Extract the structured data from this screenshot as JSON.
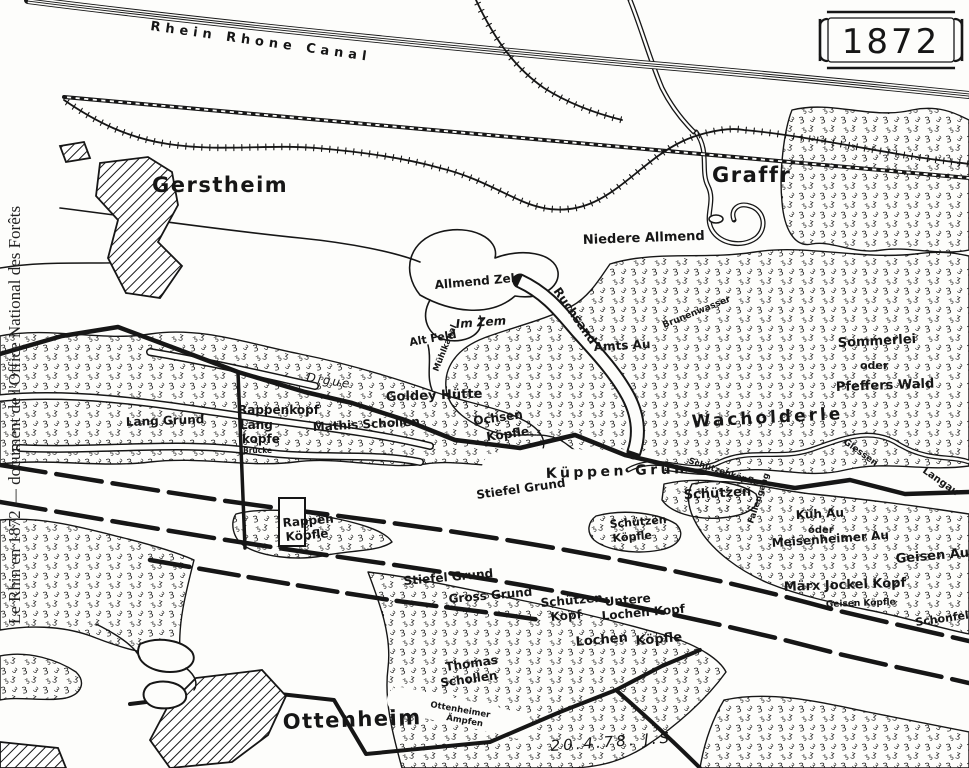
{
  "colors": {
    "ink": "#161616",
    "paper": "#fdfdfb"
  },
  "margin_caption": "Le Rhin en 1872 — document de l'Office National des Forêts",
  "cartouche": {
    "year": "1872"
  },
  "signature": "20.4.78. J.S.",
  "map": {
    "towns": [
      "Gerstheim",
      "Graffr",
      "Ottenheim"
    ],
    "waterways": [
      "Rhein Rhone Canal",
      "Ruchsand",
      "Brunenwasser",
      "Mühlkanal",
      "Giessen"
    ],
    "labels": [
      {
        "id": "canal-label",
        "text": "Rhein Rhone Canal",
        "x": 150,
        "y": 30,
        "r": 8,
        "c": "canal"
      },
      {
        "id": "gerstheim",
        "text": "Gerstheim",
        "x": 152,
        "y": 192,
        "r": 0,
        "c": "town"
      },
      {
        "id": "graffr",
        "text": "Graffr",
        "x": 712,
        "y": 182,
        "r": 0,
        "c": "town"
      },
      {
        "id": "niedere-allmend",
        "text": "Niedere Allmend",
        "x": 583,
        "y": 244,
        "r": -2,
        "c": "h13"
      },
      {
        "id": "allmend-zeh",
        "text": "Allmend Zeh",
        "x": 435,
        "y": 289,
        "r": -5,
        "c": "h12"
      },
      {
        "id": "im-zem",
        "text": "Im Zem",
        "x": 456,
        "y": 328,
        "r": -4,
        "c": "h12i"
      },
      {
        "id": "alt-feld",
        "text": "Alt Feld",
        "x": 410,
        "y": 346,
        "r": -10,
        "c": "h11"
      },
      {
        "id": "muhlkanal",
        "text": "Mühlkanal",
        "x": 438,
        "y": 372,
        "r": -68,
        "c": "h8"
      },
      {
        "id": "ruchsand",
        "text": "Ruchsand",
        "x": 553,
        "y": 291,
        "r": 55,
        "c": "h12"
      },
      {
        "id": "brunenwasser",
        "text": "Brunenwasser",
        "x": 664,
        "y": 328,
        "r": -22,
        "c": "h9"
      },
      {
        "id": "amts-au",
        "text": "Amts Au",
        "x": 594,
        "y": 351,
        "r": -3,
        "c": "h12"
      },
      {
        "id": "sommerlei",
        "text": "Sommerlei",
        "x": 838,
        "y": 347,
        "r": -3,
        "c": "h13"
      },
      {
        "id": "oder-1",
        "text": "oder",
        "x": 860,
        "y": 369,
        "r": 0,
        "c": "h11"
      },
      {
        "id": "pfeffers-wald",
        "text": "Pfeffers Wald",
        "x": 836,
        "y": 391,
        "r": -2,
        "c": "h13"
      },
      {
        "id": "wacholderle",
        "text": "Wacholderle",
        "x": 692,
        "y": 427,
        "r": -3,
        "c": "h16"
      },
      {
        "id": "digue",
        "text": "Digue",
        "x": 306,
        "y": 381,
        "r": 9,
        "c": "script"
      },
      {
        "id": "lang-grund",
        "text": "Lang Grund",
        "x": 126,
        "y": 426,
        "r": -2,
        "c": "h12"
      },
      {
        "id": "rappenkopf-1",
        "text": "Rappenkopf",
        "x": 238,
        "y": 414,
        "r": 0,
        "c": "h12"
      },
      {
        "id": "rappenkopf-2",
        "text": "Lang",
        "x": 240,
        "y": 429,
        "r": 0,
        "c": "h12"
      },
      {
        "id": "rappenkopf-3",
        "text": "kopfe",
        "x": 242,
        "y": 443,
        "r": 0,
        "c": "h12"
      },
      {
        "id": "brucke",
        "text": "Brücke",
        "x": 243,
        "y": 453,
        "r": 0,
        "c": "h7"
      },
      {
        "id": "mathis-schollen",
        "text": "Mathis Schollen",
        "x": 313,
        "y": 431,
        "r": -3,
        "c": "h12"
      },
      {
        "id": "goldey-hutte",
        "text": "Goldey Hütte",
        "x": 386,
        "y": 401,
        "r": -2,
        "c": "h13"
      },
      {
        "id": "ochsen",
        "text": "Ochsen",
        "x": 474,
        "y": 425,
        "r": -8,
        "c": "h12"
      },
      {
        "id": "ochsen-kopfle",
        "text": "Köpfle",
        "x": 487,
        "y": 441,
        "r": -8,
        "c": "h12"
      },
      {
        "id": "kuppen-grun",
        "text": "Küppen Grün",
        "x": 546,
        "y": 478,
        "r": -2,
        "c": "h14"
      },
      {
        "id": "stiefel-grund-1",
        "text": "Stiefel Grund",
        "x": 477,
        "y": 499,
        "r": -8,
        "c": "h12"
      },
      {
        "id": "schutzen",
        "text": "Schützen",
        "x": 684,
        "y": 499,
        "r": -3,
        "c": "h13"
      },
      {
        "id": "schutzenkopfle-giessen",
        "text": "Schützenköpfle",
        "x": 688,
        "y": 463,
        "r": 18,
        "c": "h8"
      },
      {
        "id": "giessen",
        "text": "Giessen",
        "x": 843,
        "y": 443,
        "r": 36,
        "c": "h9"
      },
      {
        "id": "schutzen-kopfle-1",
        "text": "Schützen",
        "x": 610,
        "y": 528,
        "r": -5,
        "c": "h11"
      },
      {
        "id": "schutzen-kopfle-2",
        "text": "Köpfle",
        "x": 613,
        "y": 542,
        "r": -5,
        "c": "h11"
      },
      {
        "id": "kuh-au",
        "text": "Küh Au",
        "x": 796,
        "y": 519,
        "r": -3,
        "c": "h12"
      },
      {
        "id": "oder-2",
        "text": "oder",
        "x": 808,
        "y": 533,
        "r": 0,
        "c": "h10"
      },
      {
        "id": "meisenheimer-au",
        "text": "Meisenheimer Au",
        "x": 772,
        "y": 547,
        "r": -4,
        "c": "h12"
      },
      {
        "id": "geisen-au",
        "text": "Geisen Au",
        "x": 896,
        "y": 563,
        "r": -5,
        "c": "h13"
      },
      {
        "id": "marx-jockel-kopf",
        "text": "Märx Jockel Kopf",
        "x": 784,
        "y": 591,
        "r": -2,
        "c": "h13"
      },
      {
        "id": "geisen-kopfle",
        "text": "Geisen Köpfle",
        "x": 826,
        "y": 607,
        "r": -2,
        "c": "h9"
      },
      {
        "id": "schonfeld",
        "text": "Schonfeld",
        "x": 916,
        "y": 626,
        "r": -8,
        "c": "h11"
      },
      {
        "id": "langau",
        "text": "Langau",
        "x": 922,
        "y": 472,
        "r": 35,
        "c": "h10"
      },
      {
        "id": "fallengang",
        "text": "Fallengang",
        "x": 753,
        "y": 524,
        "r": -72,
        "c": "h8"
      },
      {
        "id": "rappen-kopfle-1",
        "text": "Rappen",
        "x": 283,
        "y": 527,
        "r": -5,
        "c": "h12"
      },
      {
        "id": "rappen-kopfle-2",
        "text": "Köpfle",
        "x": 286,
        "y": 541,
        "r": -5,
        "c": "h12"
      },
      {
        "id": "stiefel-grund-2",
        "text": "Stiefel Grund",
        "x": 404,
        "y": 585,
        "r": -5,
        "c": "h12"
      },
      {
        "id": "gross-grund",
        "text": "Gross Grund",
        "x": 449,
        "y": 603,
        "r": -5,
        "c": "h12"
      },
      {
        "id": "schutzen-kopf-1",
        "text": "Schützen",
        "x": 541,
        "y": 607,
        "r": -5,
        "c": "h12"
      },
      {
        "id": "schutzen-kopf-2",
        "text": "Kopf",
        "x": 551,
        "y": 621,
        "r": -5,
        "c": "h12"
      },
      {
        "id": "untere",
        "text": "Untere",
        "x": 605,
        "y": 606,
        "r": -5,
        "c": "h12"
      },
      {
        "id": "lochen-kopf",
        "text": "Lochen Kopf",
        "x": 602,
        "y": 620,
        "r": -5,
        "c": "h12"
      },
      {
        "id": "lochen",
        "text": "Lochen",
        "x": 576,
        "y": 646,
        "r": -5,
        "c": "h13"
      },
      {
        "id": "lochen-kopfle",
        "text": "Köpfle",
        "x": 636,
        "y": 645,
        "r": -5,
        "c": "h13"
      },
      {
        "id": "thomas-1",
        "text": "Thomas",
        "x": 446,
        "y": 671,
        "r": -8,
        "c": "h12"
      },
      {
        "id": "thomas-2",
        "text": "Schollen",
        "x": 441,
        "y": 687,
        "r": -8,
        "c": "h12"
      },
      {
        "id": "ottenheimer-1",
        "text": "Ottenheimer",
        "x": 430,
        "y": 707,
        "r": 10,
        "c": "h8"
      },
      {
        "id": "ottenheimer-2",
        "text": "Ämpfen",
        "x": 446,
        "y": 720,
        "r": 10,
        "c": "h8"
      },
      {
        "id": "ottenheim",
        "text": "Ottenheim",
        "x": 283,
        "y": 729,
        "r": -2,
        "c": "town"
      },
      {
        "id": "date-sig",
        "text": "20.4.78. J.S.",
        "x": 551,
        "y": 751,
        "r": -4,
        "c": "date"
      },
      {
        "id": "year",
        "text": "1872",
        "x": 891,
        "y": 53,
        "r": 0,
        "c": "year"
      },
      {
        "id": "caption",
        "text": "Le Rhin en 1872 — document de l'Office National des Forêts",
        "x": 20,
        "y": 415,
        "r": -90,
        "c": "caption"
      }
    ]
  }
}
